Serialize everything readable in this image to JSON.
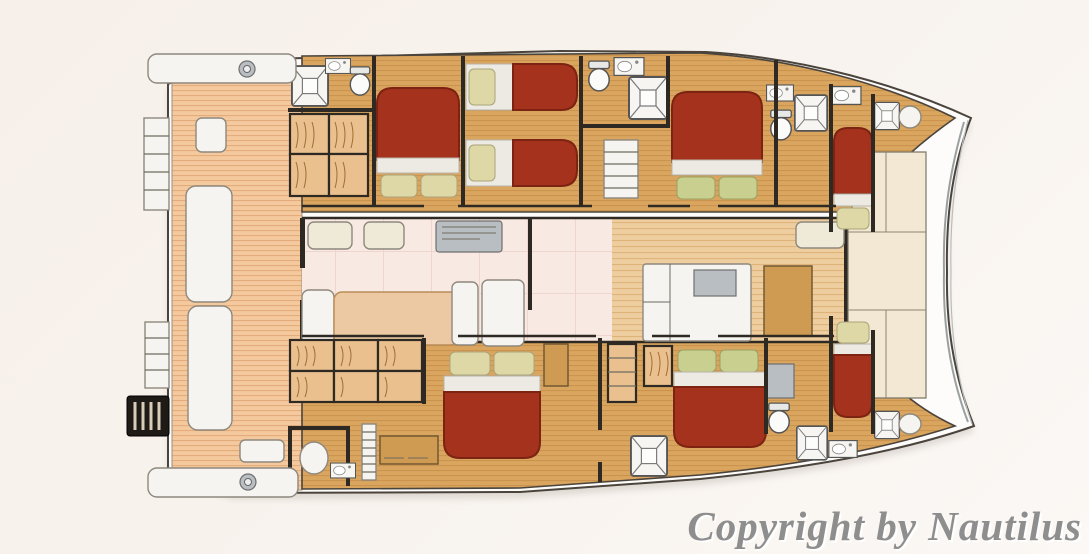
{
  "watermark": {
    "text": "Copyright by Nautilus"
  },
  "palette": {
    "hull-white": "#fdfcfa",
    "hull-outline": "#4a443c",
    "cabin-wood": "#d9a55f",
    "cabin-wood-line": "#c8924c",
    "deck-plank": "#f5c99e",
    "deck-plank-line": "#e3a878",
    "side-plank": "#eecd9f",
    "side-plank-line": "#dcb177",
    "saloon-floor": "#f9e9e3",
    "saloon-grid": "#eed6cc",
    "foredeck": "#f2e8d3",
    "bed-red": "#a5321d",
    "bed-red-dark": "#7c2312",
    "sheet-white": "#eceae3",
    "pillow-cream": "#ddd8a6",
    "pillow-green": "#c9cf8e",
    "furniture-white": "#f5f4f0",
    "wall-dark": "#2e2922",
    "fixture-gray": "#b9bec2",
    "wood-mid": "#cf9a52",
    "watermark-gray": "#8e8e8e"
  },
  "floorplan": {
    "subject": "catamaran yacht deck plan, bow to the right",
    "double_beds": 4,
    "single_berths": 4,
    "bathrooms": 6,
    "showers": 6,
    "toilets": 6,
    "stairways": 2,
    "winches": 2
  }
}
